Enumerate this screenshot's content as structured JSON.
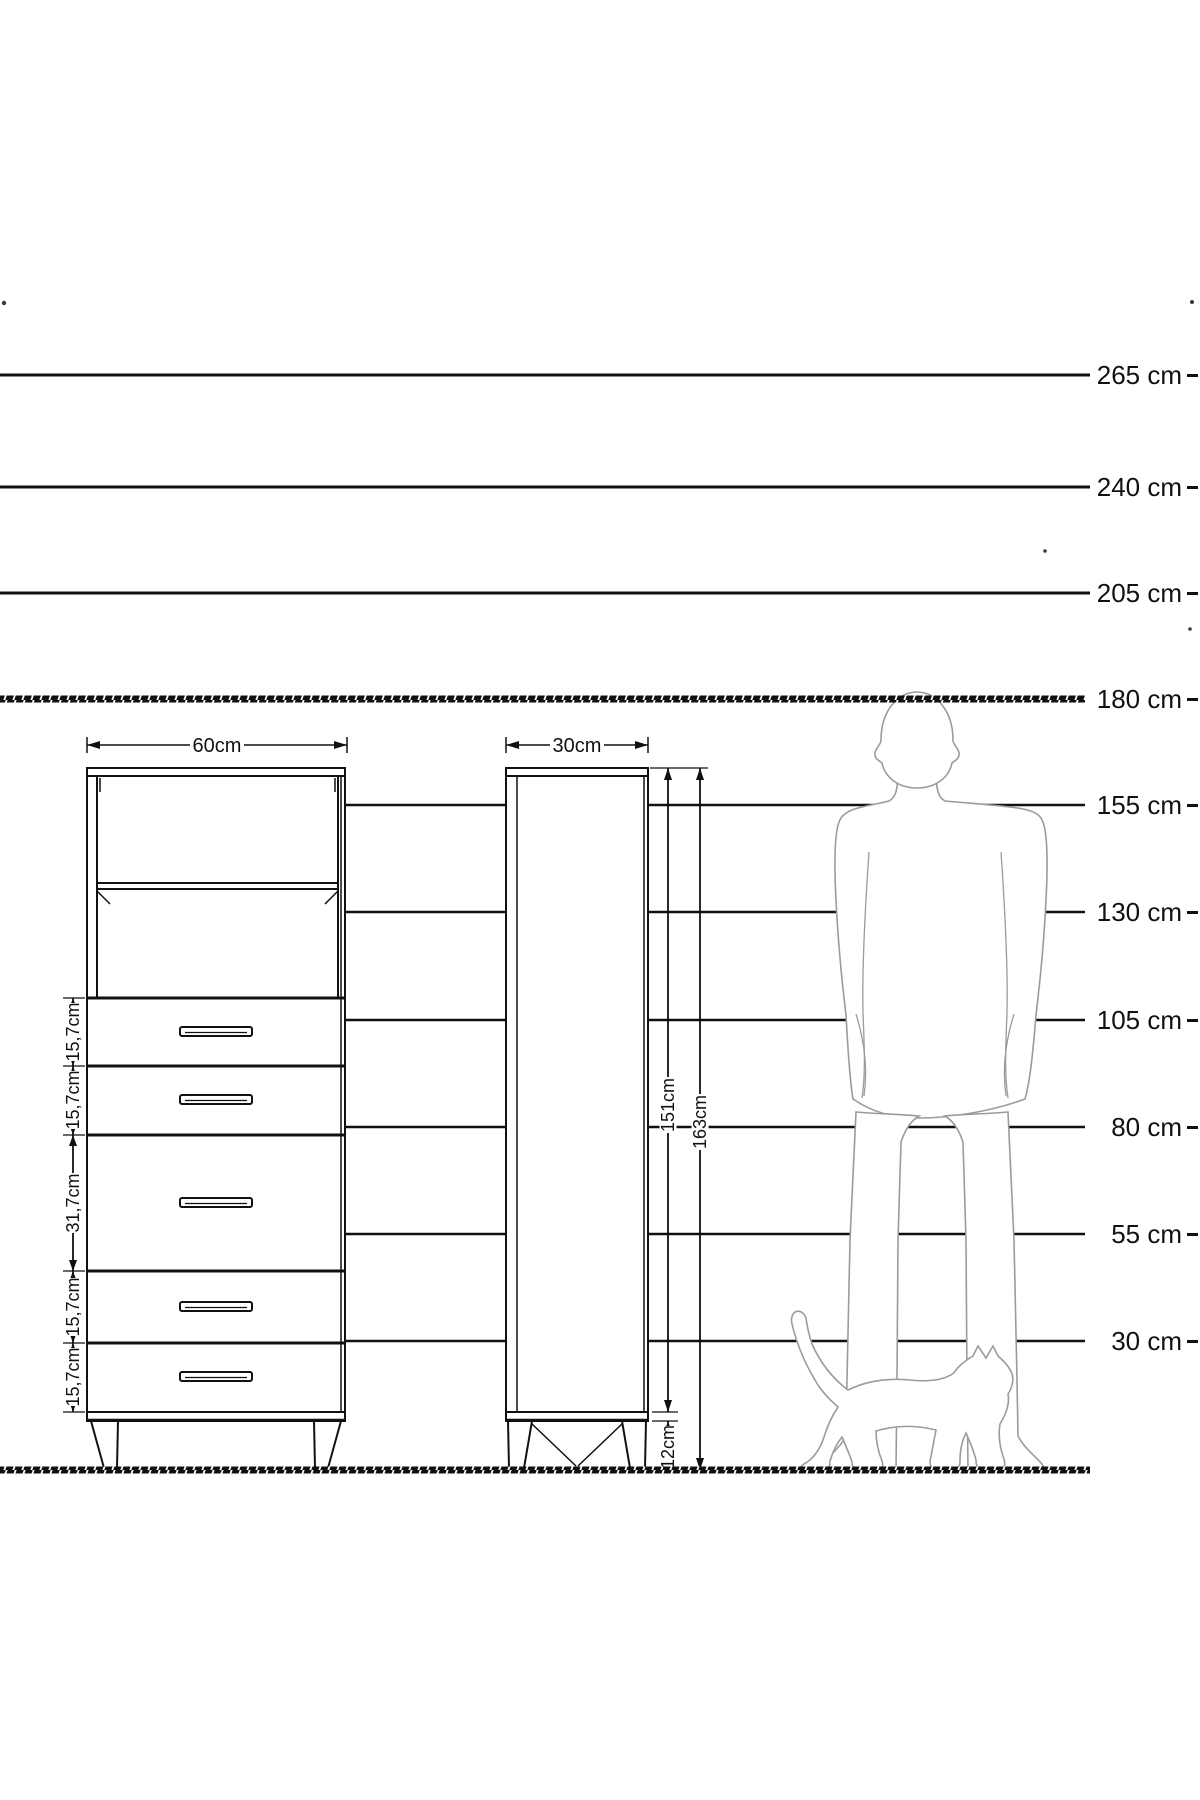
{
  "ruler": {
    "unit": "cm",
    "lines": [
      {
        "label": "265 cm",
        "y": 375,
        "x1": 0,
        "x2": 1090,
        "style": "solid",
        "layer": "over"
      },
      {
        "label": "240 cm",
        "y": 487,
        "x1": 0,
        "x2": 1090,
        "style": "solid",
        "layer": "over"
      },
      {
        "label": "205 cm",
        "y": 593,
        "x1": 0,
        "x2": 1090,
        "style": "solid",
        "layer": "over"
      },
      {
        "label": "180 cm",
        "y": 699,
        "x1": 0,
        "x2": 1085,
        "style": "hatched",
        "layer": "over"
      },
      {
        "label": "155 cm",
        "y": 805,
        "x1": 345,
        "x2": 1085,
        "style": "solid",
        "layer": "under"
      },
      {
        "label": "130 cm",
        "y": 912,
        "x1": 345,
        "x2": 1085,
        "style": "solid",
        "layer": "under"
      },
      {
        "label": "105 cm",
        "y": 1020,
        "x1": 345,
        "x2": 1085,
        "style": "solid",
        "layer": "under"
      },
      {
        "label": "80 cm",
        "y": 1127,
        "x1": 345,
        "x2": 1085,
        "style": "solid",
        "layer": "under"
      },
      {
        "label": "55 cm",
        "y": 1234,
        "x1": 345,
        "x2": 1085,
        "style": "solid",
        "layer": "under"
      },
      {
        "label": "30 cm",
        "y": 1341,
        "x1": 345,
        "x2": 1085,
        "style": "solid",
        "layer": "under"
      }
    ],
    "ground": {
      "y": 1470,
      "x1": 0,
      "x2": 1090,
      "style": "hatched"
    }
  },
  "front_view": {
    "width_label": "60cm",
    "drawer_height_labels": [
      "15,7cm",
      "15,7cm",
      "31,7cm",
      "15,7cm",
      "15,7cm"
    ]
  },
  "side_view": {
    "width_label": "30cm",
    "carcass_height_label": "151cm",
    "total_height_label": "163cm",
    "leg_height_label": "12cm"
  },
  "figures": {
    "man": "man-silhouette-180cm",
    "cat": "walking-cat-silhouette"
  },
  "colors": {
    "line": "#111111",
    "figure_outline": "#9b9b9b",
    "background": "#ffffff"
  }
}
